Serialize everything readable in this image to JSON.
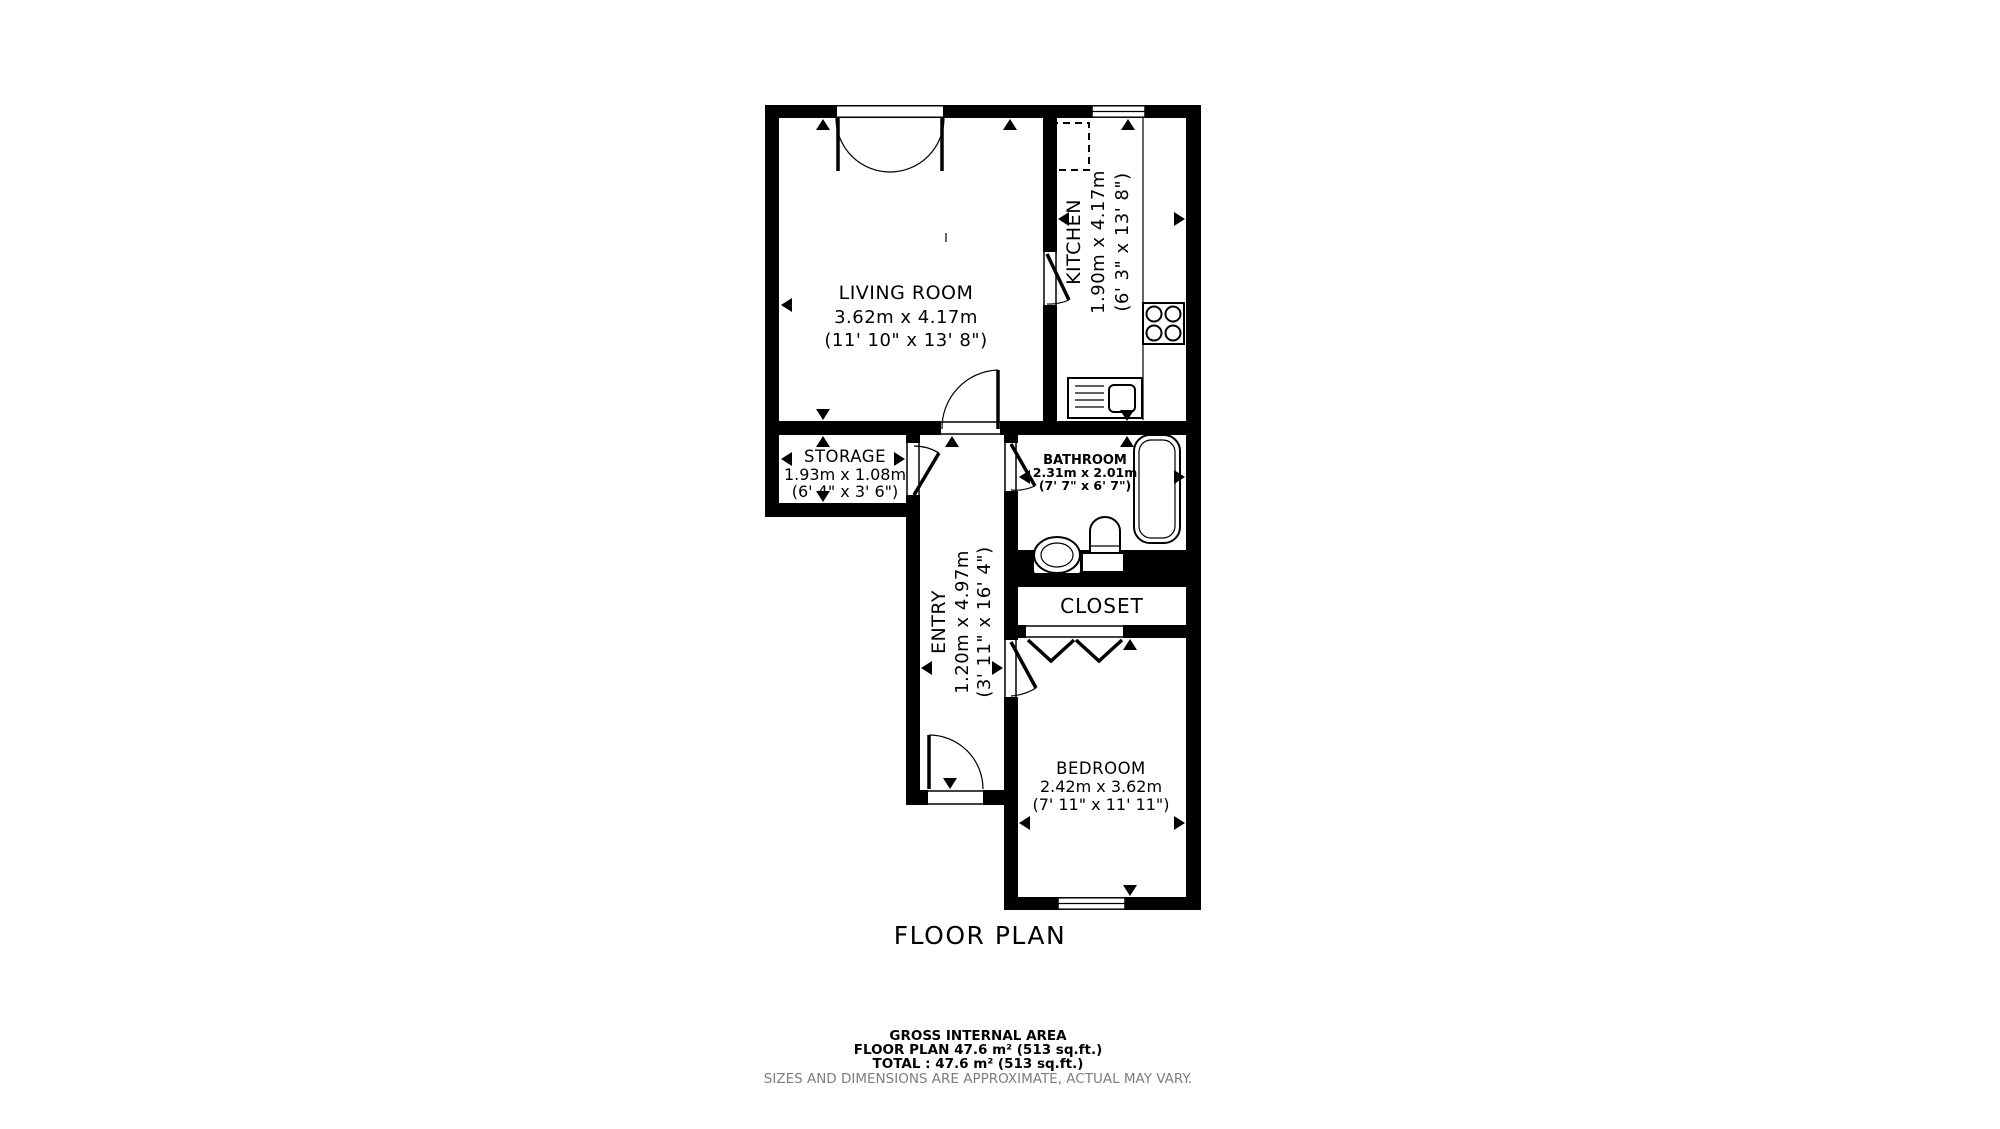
{
  "title": "FLOOR PLAN",
  "rooms": {
    "living_room": {
      "name": "LIVING ROOM",
      "metric": "3.62m x 4.17m",
      "imperial": "(11' 10\" x 13' 8\")"
    },
    "kitchen": {
      "name": "KITCHEN",
      "metric": "1.90m x 4.17m",
      "imperial": "(6' 3\" x 13' 8\")"
    },
    "storage": {
      "name": "STORAGE",
      "metric": "1.93m x 1.08m",
      "imperial": "(6' 4\" x 3' 6\")"
    },
    "bathroom": {
      "name": "BATHROOM",
      "metric": "2.31m x 2.01m",
      "imperial": "(7' 7\" x 6' 7\")"
    },
    "entry": {
      "name": "ENTRY",
      "metric": "1.20m x 4.97m",
      "imperial": "(3' 11\" x 16' 4\")"
    },
    "closet": {
      "name": "CLOSET"
    },
    "bedroom": {
      "name": "BEDROOM",
      "metric": "2.42m x 3.62m",
      "imperial": "(7' 11\" x 11' 11\")"
    }
  },
  "footer": {
    "area_heading": "GROSS INTERNAL AREA",
    "floor_plan_area": "FLOOR PLAN 47.6 m² (513 sq.ft.)",
    "total_area": "TOTAL :  47.6 m² (513 sq.ft.)",
    "disclaimer": "SIZES AND DIMENSIONS ARE APPROXIMATE, ACTUAL MAY VARY."
  },
  "colors": {
    "wall": "#000000",
    "background": "#ffffff",
    "disclaimer_text": "#7d7d7d"
  }
}
